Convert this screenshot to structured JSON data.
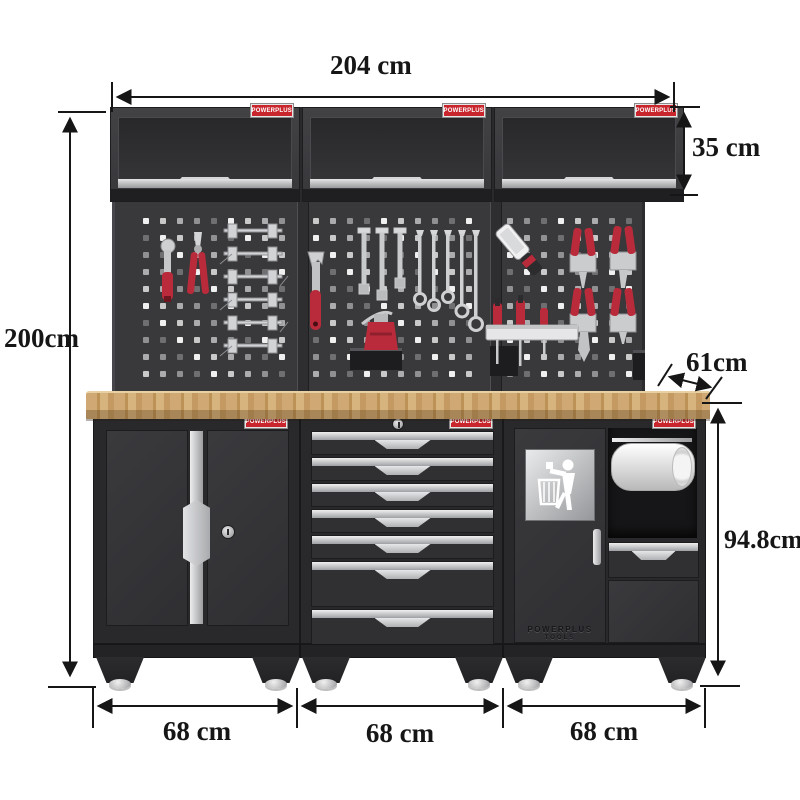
{
  "dimensions": {
    "width_label": "204 cm",
    "height_label": "200cm",
    "wall_cabinet_height_label": "35 cm",
    "depth_label": "61cm",
    "workbench_height_label": "94.8cm",
    "module_width_labels": [
      "68 cm",
      "68 cm",
      "68 cm"
    ]
  },
  "brand": {
    "logo_text": "POWERPLUS",
    "embossed_line1": "POWERPLUS",
    "embossed_line2": "TOOLS"
  },
  "product": {
    "wall_cabinet_count": "3",
    "drawer_count": "7"
  },
  "colors": {
    "cabinet_dark": "#323235",
    "accent_red": "#c8252c",
    "worktop_wood": "#c9a26b",
    "chrome": "#d3d4d6",
    "dimension_ink": "#161616"
  }
}
